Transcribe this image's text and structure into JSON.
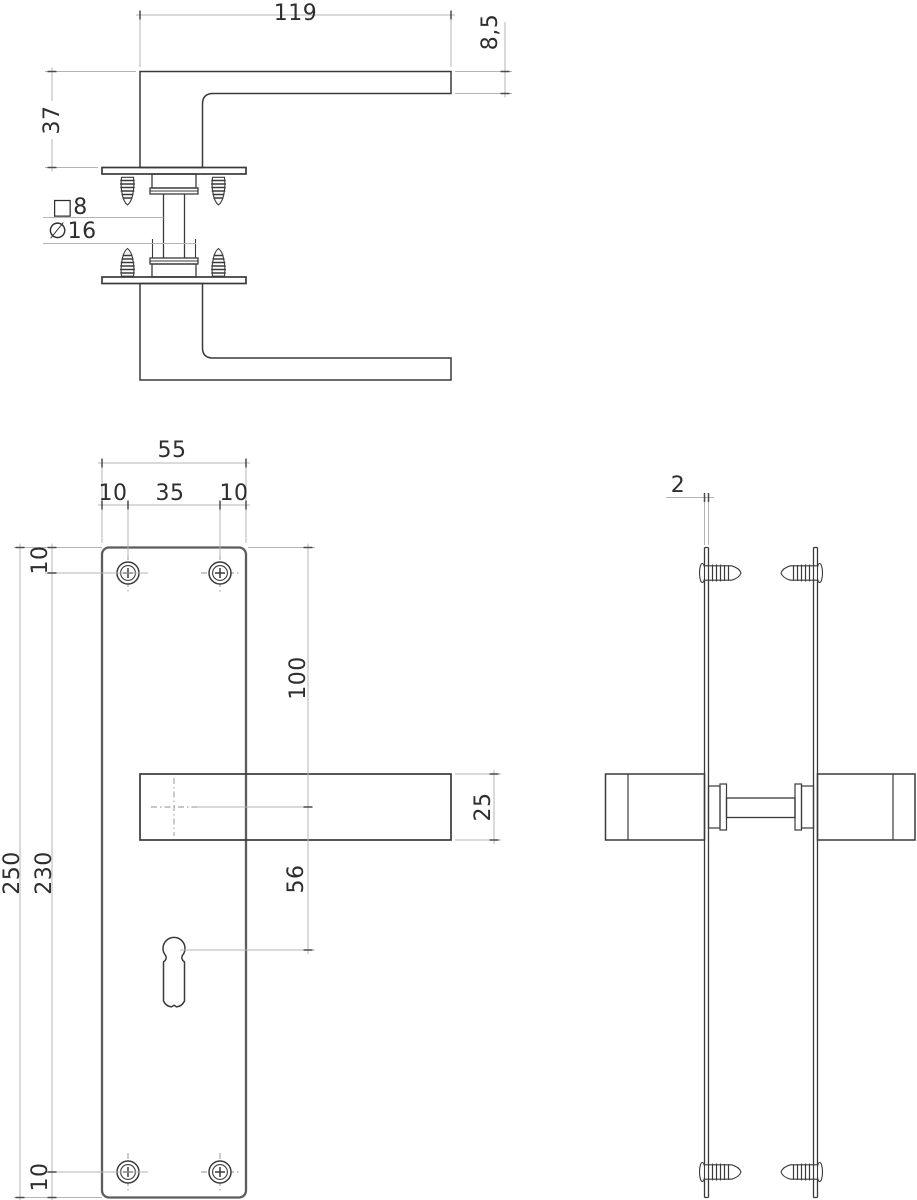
{
  "views": {
    "handle_side": {
      "length": "119",
      "grip_thickness": "8,5",
      "height": "37",
      "spindle_square": "□8",
      "neck_diameter": "∅16"
    },
    "plate_front": {
      "plate_width": "55",
      "screw_left_offset": "10",
      "screw_spacing": "35",
      "screw_right_offset": "10",
      "top_screw_from_top": "10",
      "handle_center_from_top": "100",
      "plate_height": "250",
      "screw_center_distance": "230",
      "keyhole_from_handle": "56",
      "grip_width": "25",
      "bottom_screw_from_bottom": "10"
    },
    "plate_side": {
      "plate_thickness": "2"
    }
  },
  "colors": {
    "outline": "#3a3a3a",
    "plate_outline": "#5c5c5c",
    "dimension_line": "#b4b4b4",
    "tick": "#4c4c4c",
    "text": "#2e2e2e",
    "background": "#ffffff"
  }
}
